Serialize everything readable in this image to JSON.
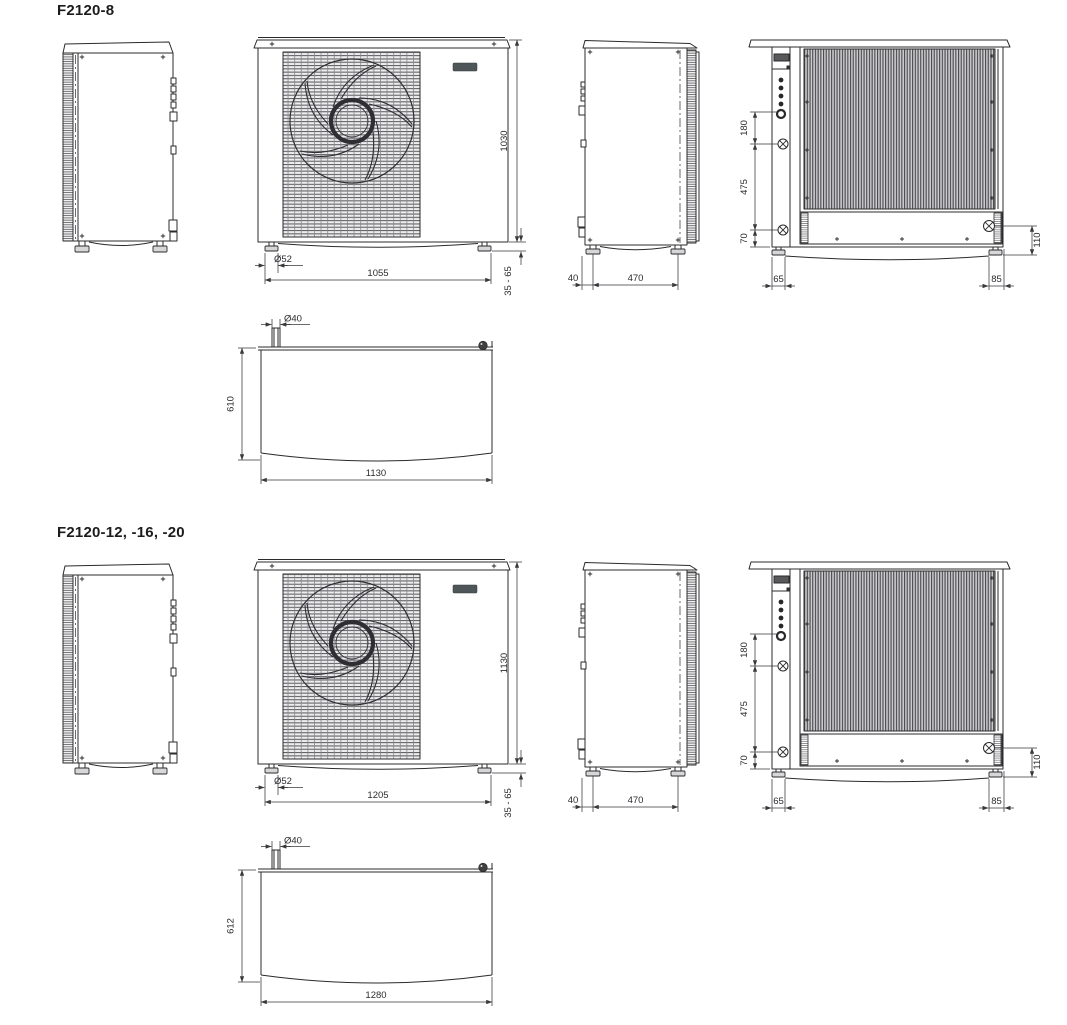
{
  "palette": {
    "line": "#2b2b2e",
    "fill_gray": "#d7d7d9",
    "badge": "#4e565a",
    "background": "#ffffff"
  },
  "sections": [
    {
      "title": "F2120-8",
      "views": {
        "front": {
          "height": "1030",
          "foot_range": "35 - 65",
          "foot_dia": "Ø52",
          "width": "1055"
        },
        "side_right": {
          "front_offset": "40",
          "foot_spacing": "470"
        },
        "back": {
          "conn_spacing": "180",
          "conn_to_bottom": "475",
          "bottom_offset": "70",
          "left_offset": "65",
          "right_offset": "85",
          "right_height": "110"
        },
        "top": {
          "pipe_dia": "Ø40",
          "depth": "610",
          "width": "1130"
        }
      }
    },
    {
      "title": "F2120-12, -16, -20",
      "views": {
        "front": {
          "height": "1130",
          "foot_range": "35 - 65",
          "foot_dia": "Ø52",
          "width": "1205"
        },
        "side_right": {
          "front_offset": "40",
          "foot_spacing": "470"
        },
        "back": {
          "conn_spacing": "180",
          "conn_to_bottom": "475",
          "bottom_offset": "70",
          "left_offset": "65",
          "right_offset": "85",
          "right_height": "110"
        },
        "top": {
          "pipe_dia": "Ø40",
          "depth": "612",
          "width": "1280"
        }
      }
    }
  ]
}
